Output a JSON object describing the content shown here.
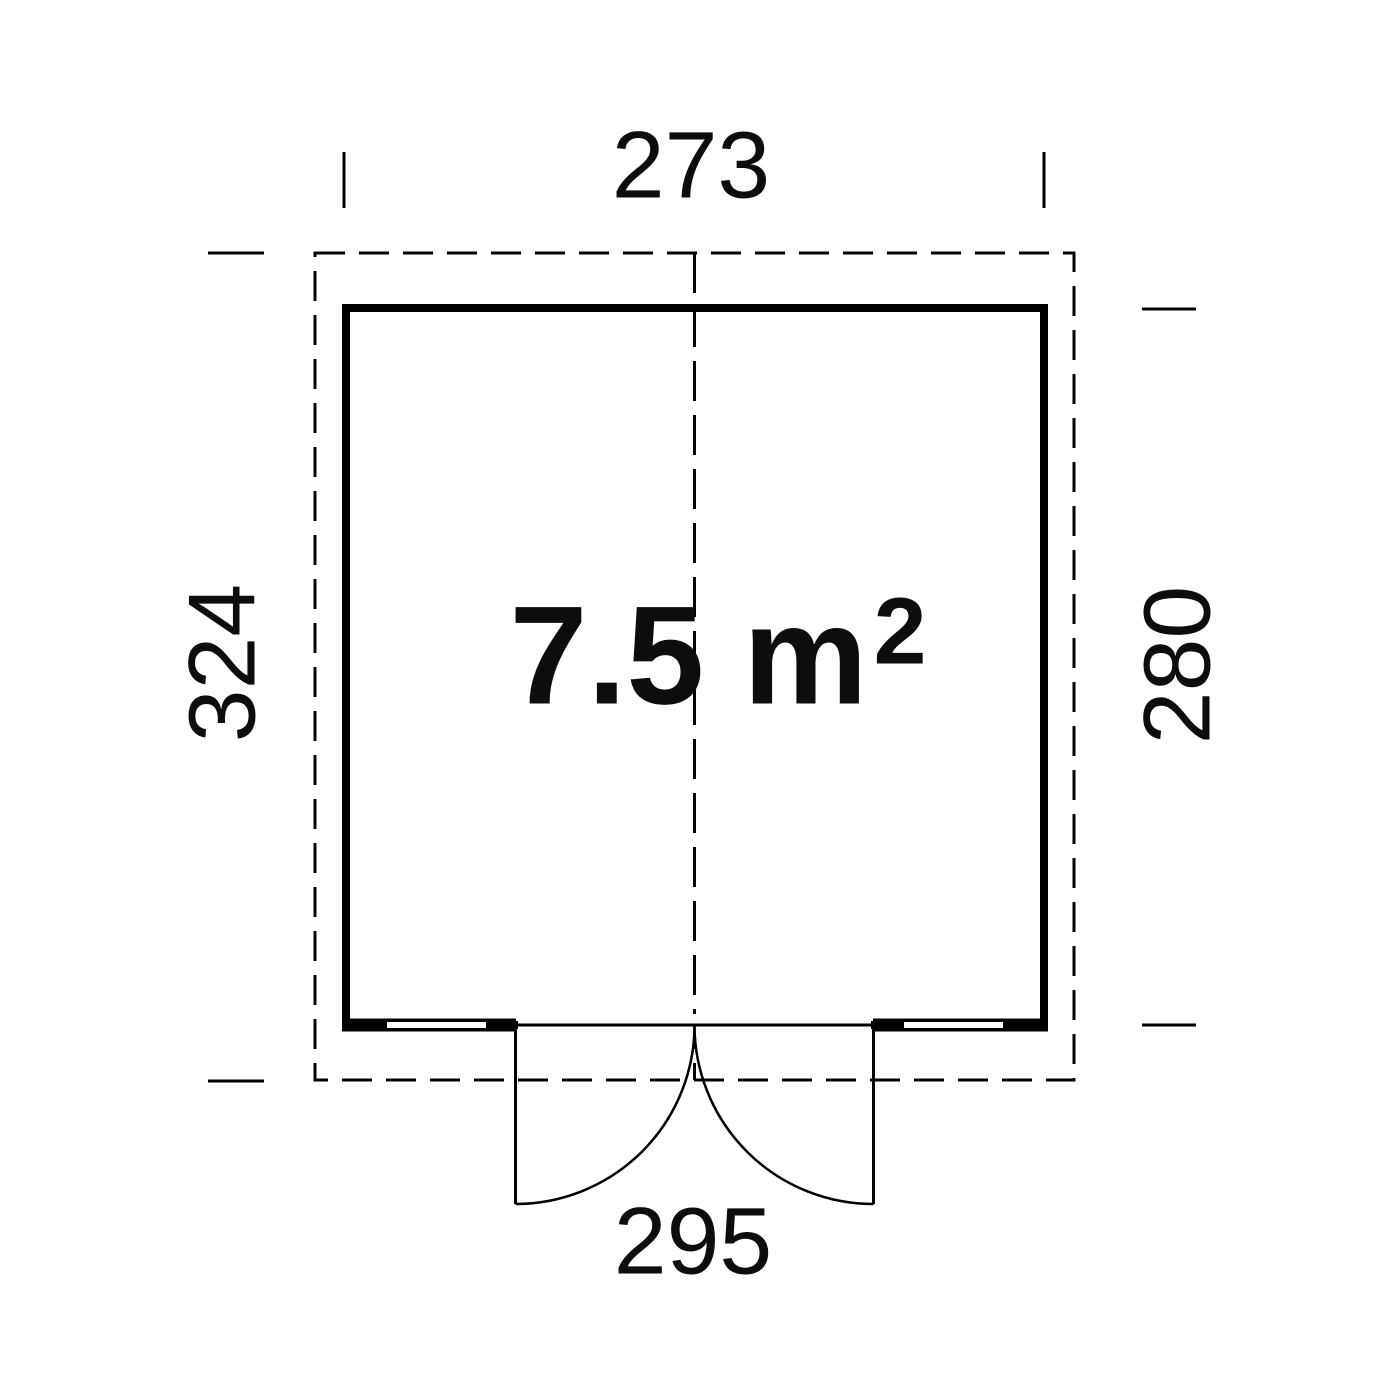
{
  "diagram": {
    "type": "floor-plan",
    "area": {
      "value": "7.5 m",
      "sup": "2"
    },
    "dims": {
      "top": "273",
      "left": "324",
      "right": "280",
      "bottom": "295"
    },
    "colors": {
      "line": "#000000",
      "background": "#ffffff"
    }
  }
}
